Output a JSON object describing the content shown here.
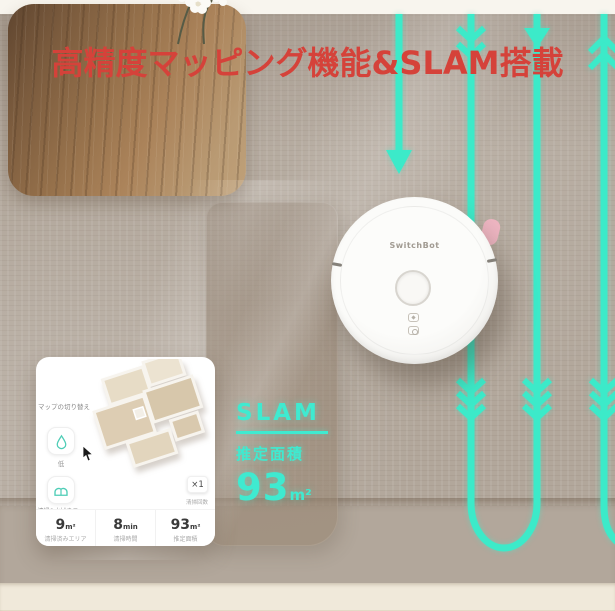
{
  "title": {
    "text": "高精度マッピング機能&SLAM搭載",
    "color": "#d5423a"
  },
  "scene": {
    "robot_brand": "SwitchBot",
    "path_color": "#3ceac9",
    "description_icons": [
      "cleaning-path-lines",
      "down-arrow-icon",
      "up-chevron-icon",
      "down-chevron-icon"
    ]
  },
  "slam_overlay": {
    "heading": "SLAM",
    "area_label": "推定面積",
    "area_value": "93",
    "area_unit": "m²",
    "color": "#3fead0"
  },
  "app_card": {
    "map_switch_label": "マップの切り替え",
    "water_level": "低",
    "mode_label": "清掃&水拭きモード",
    "count_chip": "×1",
    "count_label": "清掃回数",
    "stats": [
      {
        "value": "9",
        "unit": "m²",
        "label": "清掃済みエリア"
      },
      {
        "value": "8",
        "unit": "min",
        "label": "清掃時間"
      },
      {
        "value": "93",
        "unit": "m²",
        "label": "推定面積"
      }
    ],
    "icons": [
      "water-drop-icon",
      "mop-pads-icon"
    ]
  }
}
